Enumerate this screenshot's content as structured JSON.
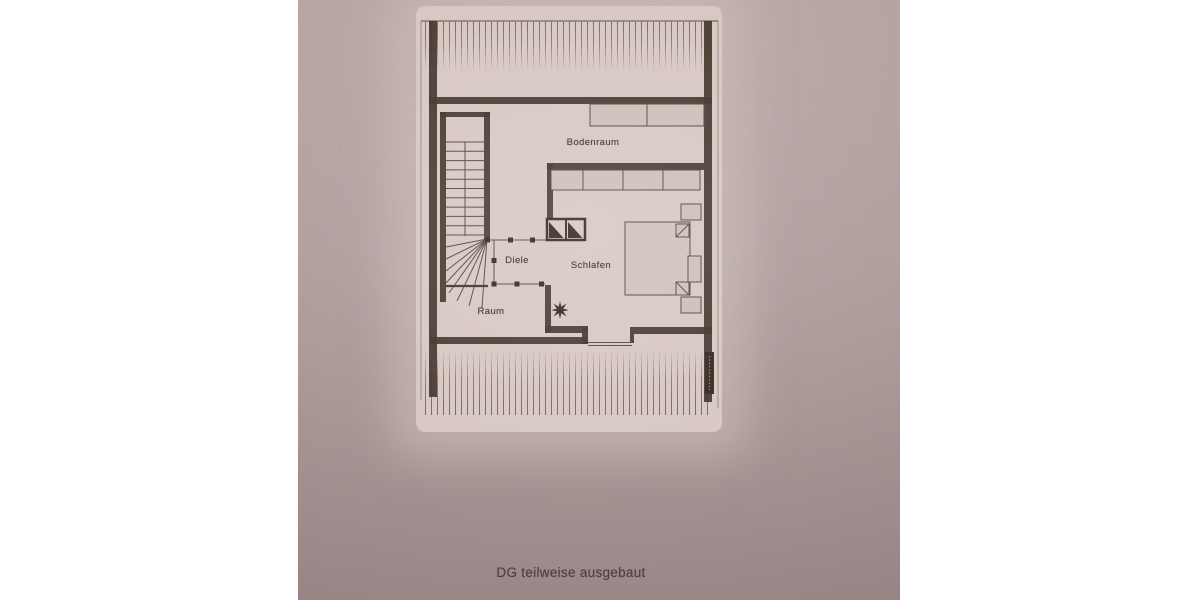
{
  "document": {
    "type": "floor-plan-photo",
    "caption": "DG teilweise ausgebaut"
  },
  "plan": {
    "rooms": {
      "bodenraum": "Bodenraum",
      "diele": "Diele",
      "schlafen": "Schlafen",
      "raum": "Raum"
    },
    "symbols": [
      "staircase",
      "chimney",
      "double-bed",
      "closet-row",
      "cabinet",
      "dormer-window",
      "star-symbol",
      "roof-hatching"
    ]
  },
  "colors": {
    "photo-top": "#bcaaa9",
    "photo-bottom": "#a08d8d",
    "paper": "#d8c9c5",
    "wall": "#473a31",
    "ink": "#5d4c44",
    "furn-fill": "#cfc1bc",
    "furn-stroke": "#5d4c44",
    "label": "#3f3536",
    "caption": "#4b3f42"
  }
}
